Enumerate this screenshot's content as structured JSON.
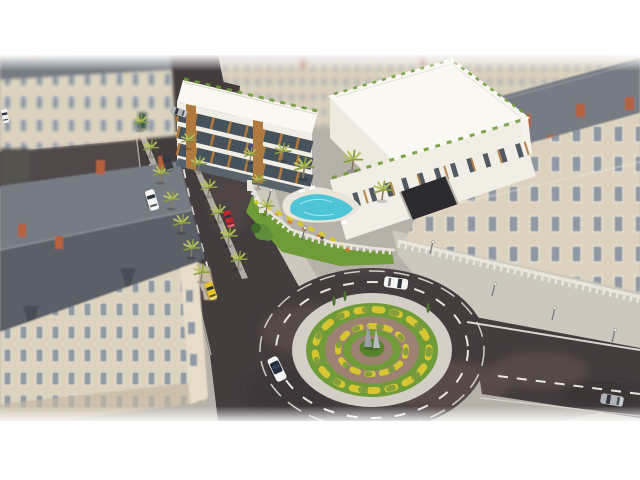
{
  "meta": {
    "type": "3d-architectural-aerial-render",
    "description": "Tilt-shift aerial render of a modern white residential complex with rooftop gardens and a swimming pool, set among classical Haussmann-style buildings, a palm-lined boulevard and a landscaped roundabout",
    "letterbox": "white bars top and bottom"
  },
  "palette": {
    "background": "#ffffff",
    "cobble": "#b7b2a9",
    "cobble_light": "#c9c4bb",
    "sidewalk": "#cdc8be",
    "median": "#b2ada4",
    "asphalt": "#453c3e",
    "asphalt_light": "#5d5150",
    "asphalt_patch": "#6b5a4d",
    "asphalt_dark": "#2e292b",
    "marking": "#e9e7e1",
    "facade_cream": "#ddd2bd",
    "facade_light": "#e6dcc8",
    "facade_shadow": "#c4b8a2",
    "window_glass": "#8e99a4",
    "window_frame": "#f0ebdf",
    "roof_slate": "#767b84",
    "roof_slate_dark": "#5a5f68",
    "roof_ridge": "#8d929a",
    "chimney_brick": "#b5623c",
    "turret_dark": "#4a4e57",
    "modern_white": "#f1eee6",
    "modern_roof": "#faf8f2",
    "modern_shadow": "#d9d4c8",
    "wood_accent": "#b07a3e",
    "glass_dark": "#33404d",
    "pool_water": "#4ec5d6",
    "pool_deck": "#e9e5da",
    "lawn": "#6f9c38",
    "lawn_dark": "#55832c",
    "paver": "#9d8173",
    "apron": "#d3cfc6",
    "shrub_yellow": "#d7c632",
    "shrub_green": "#7d9a3f",
    "flower_orange": "#d07a28",
    "palm_frond": "#b9c05e",
    "palm_trunk": "#8a7a5e",
    "tree_green": "#5f8d3a",
    "fence_white": "#e8e5dd",
    "obelisk": "#9aa0a5",
    "lamp_grey": "#6f7276",
    "car_white": "#f4f4f2",
    "car_dark": "#3a3f46",
    "car_red": "#c0272d",
    "car_taxi": "#e8c229",
    "car_silver": "#b0b4b6",
    "garage_dark": "#2b2a2e",
    "door_green": "#2e5a52"
  },
  "scene": {
    "buildings": [
      {
        "id": "classical-top-left",
        "style": "Haussmann classical",
        "roof": "slate mansard",
        "facade": "cream stone"
      },
      {
        "id": "classical-corner-left",
        "style": "Haussmann classical with corner turrets",
        "roof": "slate mansard with orange brick chimneys",
        "facade": "cream stone"
      },
      {
        "id": "classical-row-top",
        "style": "classical street wall (blurred backdrop)",
        "facade": "cream stone"
      },
      {
        "id": "classical-right",
        "style": "Haussmann classical",
        "roof": "slate with brick chimneys",
        "facade": "cream stone"
      },
      {
        "id": "modern-complex",
        "style": "contemporary white residential",
        "features": [
          "flat white roofs",
          "rooftop hedges",
          "wood louver accents",
          "glass facades",
          "swimming pool",
          "garden lawn",
          "garage ramp",
          "white perimeter fence"
        ]
      }
    ],
    "roundabout": {
      "rings_outside_in": [
        "asphalt circulatory road",
        "white concrete apron",
        "lawn with yellow shrub ring",
        "paver ring",
        "lawn with yellow shrub ring",
        "paver circle",
        "central lawn"
      ],
      "monument": "two grey obelisk sculptures"
    },
    "roads": {
      "boulevard": "palm-lined boulevard with two planted medians and dashed lanes",
      "right_exit": "road exiting right with dashed centre line",
      "markings": "white dashed lane lines"
    },
    "vehicles": [
      {
        "id": "white-van-boulevard",
        "color_key": "car_white"
      },
      {
        "id": "dark-car-parked",
        "color_key": "car_dark"
      },
      {
        "id": "grey-van-parking",
        "color_key": "car_silver"
      },
      {
        "id": "red-car-service-lane",
        "color_key": "car_red"
      },
      {
        "id": "yellow-taxi",
        "color_key": "car_taxi"
      },
      {
        "id": "white-convertible",
        "color_key": "car_white"
      },
      {
        "id": "white-sedan-roundabout",
        "color_key": "car_white"
      },
      {
        "id": "silver-car-right-exit",
        "color_key": "car_silver"
      },
      {
        "id": "white-car-far-left",
        "color_key": "car_white"
      }
    ],
    "vegetation": {
      "palm_trees": 20,
      "leafy_trees": 1,
      "island_cypresses": 3,
      "yellow_shrub_rings": 2
    },
    "street_furniture": {
      "street_lamps": 6,
      "balustrade": "white balustrade along right building",
      "pedestrians": 1
    }
  }
}
